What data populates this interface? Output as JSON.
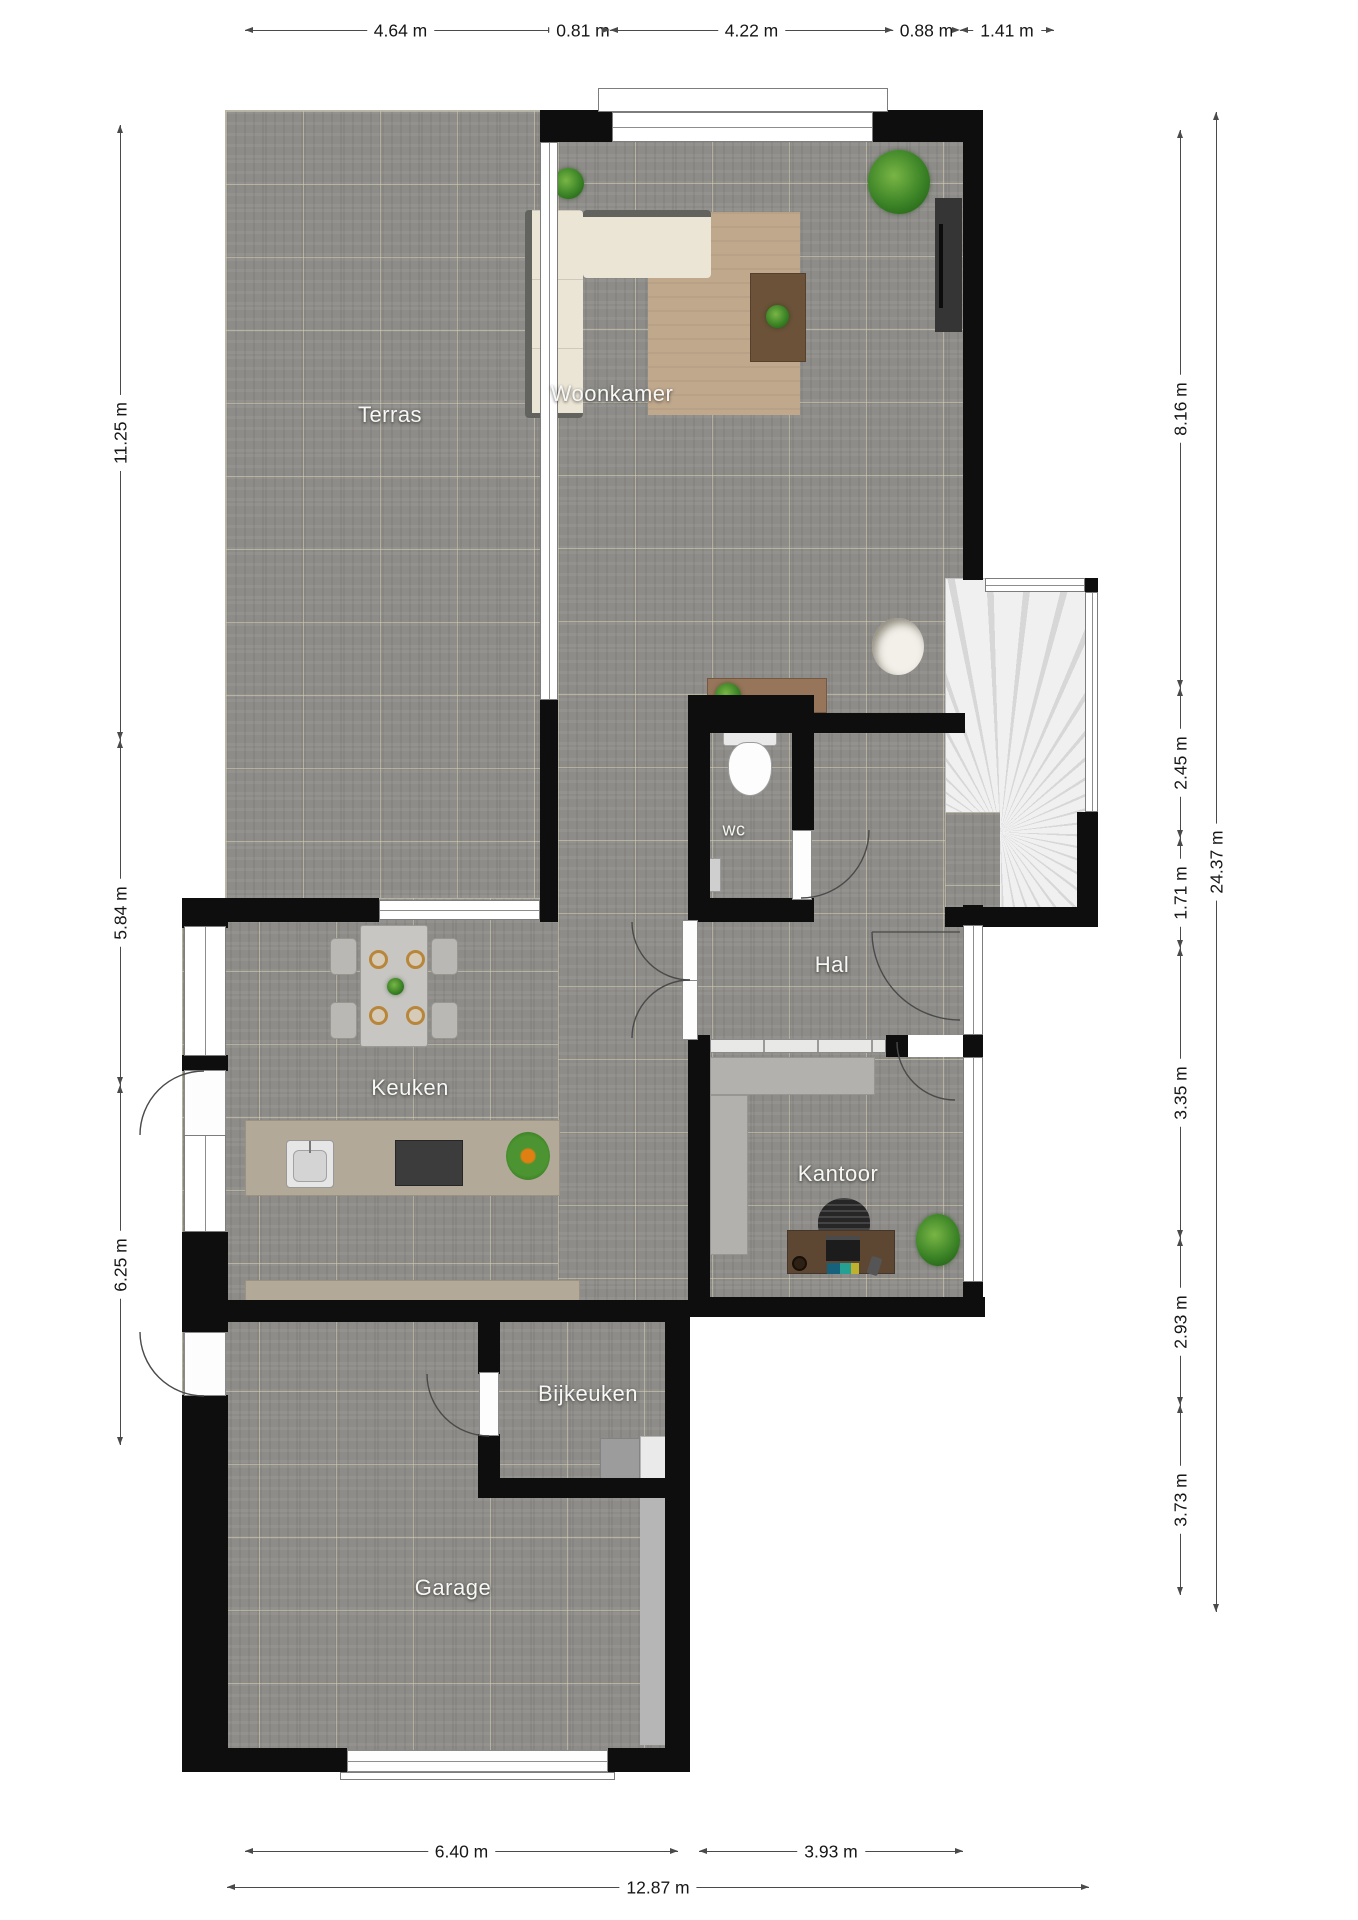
{
  "rooms": {
    "terras": "Terras",
    "woonkamer": "Woonkamer",
    "wc": "wc",
    "hal": "Hal",
    "keuken": "Keuken",
    "kantoor": "Kantoor",
    "bijkeuken": "Bijkeuken",
    "garage": "Garage"
  },
  "dimensions": {
    "top": [
      {
        "label": "4.64 m"
      },
      {
        "label": "0.81 m"
      },
      {
        "label": "4.22 m"
      },
      {
        "label": "0.88 m"
      },
      {
        "label": "1.41 m"
      }
    ],
    "left": [
      {
        "label": "11.25 m"
      },
      {
        "label": "5.84 m"
      },
      {
        "label": "6.25 m"
      }
    ],
    "right": [
      {
        "label": "8.16 m"
      },
      {
        "label": "2.45 m"
      },
      {
        "label": "1.71 m"
      },
      {
        "label": "3.35 m"
      },
      {
        "label": "2.93 m"
      },
      {
        "label": "3.73 m"
      }
    ],
    "right_total": {
      "label": "24.37 m"
    },
    "bottom": [
      {
        "label": "6.40 m"
      },
      {
        "label": "3.93 m"
      }
    ],
    "bottom_total": {
      "label": "12.87 m"
    }
  },
  "colors": {
    "wall": "#0e0e0e",
    "floor_tile": "#8d8c88",
    "counter": "#b3a999",
    "wood": "#96755a",
    "plant_green": "#3c8427",
    "dimension_text": "#161616"
  }
}
